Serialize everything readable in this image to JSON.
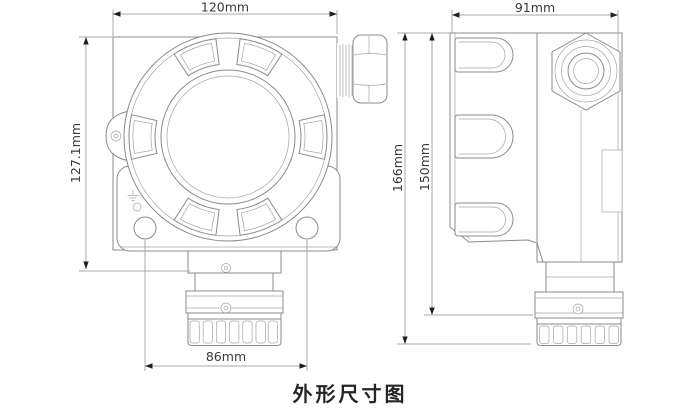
{
  "caption": "外形尺寸图",
  "front_view": {
    "width_label": "120mm",
    "height_label": "127.1mm",
    "hole_spacing_label": "86mm"
  },
  "side_view": {
    "width_label": "91mm",
    "total_height_label": "166mm",
    "body_height_label": "150mm"
  },
  "icons": {
    "earth_ground_symbol": "earth-ground"
  },
  "colors": {
    "background": "#ffffff",
    "outline": "#8b8b8b",
    "outline_light": "#a5a5a5",
    "dimension_line": "#a8a8a8",
    "arrow": "#1f1f1f",
    "dimension_text": "#3a3a3a",
    "caption_text": "#262626"
  }
}
